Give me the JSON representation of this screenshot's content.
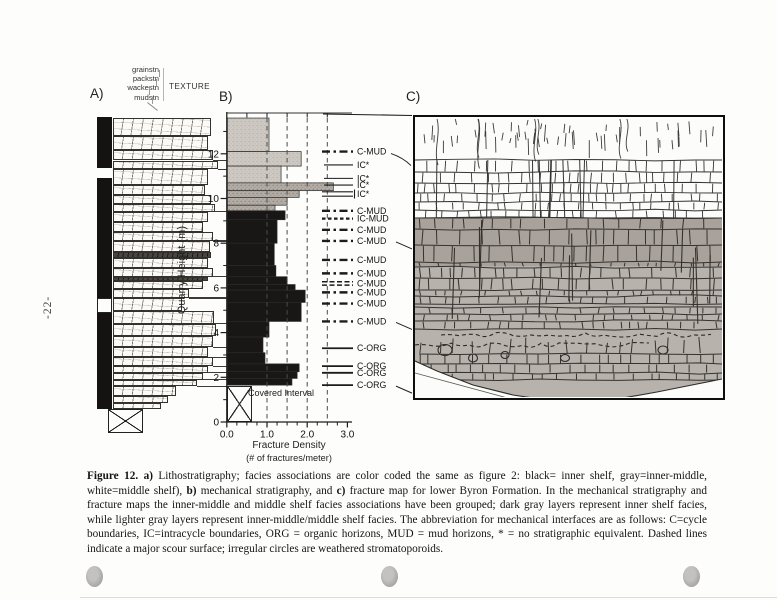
{
  "page": {
    "number": "-22-"
  },
  "panel_a": {
    "label": "A)",
    "texture_title": "TEXTURE",
    "texture_scale_labels": [
      "grainstn",
      "packstn",
      "wackestn",
      "mudstn"
    ],
    "facies_strip": [
      {
        "t": 13.65,
        "b": 11.35,
        "f": "black"
      },
      {
        "t": 11.35,
        "b": 10.9,
        "f": "white"
      },
      {
        "t": 10.9,
        "b": 5.55,
        "f": "black"
      },
      {
        "t": 5.55,
        "b": 4.88,
        "f": "outline"
      },
      {
        "t": 4.88,
        "b": 0.6,
        "f": "black"
      }
    ],
    "layers": [
      {
        "t": 13.6,
        "b": 12.8,
        "w": 0.93
      },
      {
        "t": 12.8,
        "b": 12.15,
        "w": 0.9
      },
      {
        "t": 12.15,
        "b": 11.7,
        "w": 0.95,
        "mk": true
      },
      {
        "t": 11.7,
        "b": 11.3,
        "w": 1.0,
        "mk": true
      },
      {
        "t": 11.3,
        "b": 10.6,
        "w": 0.9
      },
      {
        "t": 10.6,
        "b": 10.15,
        "w": 0.88
      },
      {
        "t": 10.15,
        "b": 9.75,
        "w": 0.93
      },
      {
        "t": 9.75,
        "b": 9.4,
        "w": 0.97,
        "mk": true
      },
      {
        "t": 9.4,
        "b": 8.95,
        "w": 0.9
      },
      {
        "t": 8.95,
        "b": 8.5,
        "w": 0.86
      },
      {
        "t": 8.5,
        "b": 8.1,
        "w": 0.95,
        "mk": true
      },
      {
        "t": 8.1,
        "b": 7.6,
        "w": 0.92
      },
      {
        "t": 7.6,
        "b": 7.35,
        "w": 0.93,
        "dk": true
      },
      {
        "t": 7.35,
        "b": 6.9,
        "w": 0.9
      },
      {
        "t": 6.9,
        "b": 6.5,
        "w": 0.95,
        "mk": true
      },
      {
        "t": 6.5,
        "b": 6.3,
        "w": 0.9,
        "dk": true
      },
      {
        "t": 6.3,
        "b": 5.95,
        "w": 0.86
      },
      {
        "t": 5.95,
        "b": 5.55,
        "w": 0.72,
        "mk": true
      },
      {
        "t": 5.55,
        "b": 4.95,
        "w": 0.66
      },
      {
        "t": 4.95,
        "b": 4.4,
        "w": 0.96,
        "mk": true
      },
      {
        "t": 4.4,
        "b": 3.85,
        "w": 0.98
      },
      {
        "t": 3.85,
        "b": 3.35,
        "w": 0.95,
        "mk": true
      },
      {
        "t": 3.35,
        "b": 2.9,
        "w": 0.9,
        "mk": true
      },
      {
        "t": 2.9,
        "b": 2.5,
        "w": 0.95,
        "mk": true
      },
      {
        "t": 2.5,
        "b": 2.2,
        "w": 0.9,
        "mk": true
      },
      {
        "t": 2.2,
        "b": 1.9,
        "w": 0.86,
        "mk": true
      },
      {
        "t": 1.9,
        "b": 1.6,
        "w": 0.8,
        "mk": true
      },
      {
        "t": 1.6,
        "b": 1.15,
        "w": 0.6
      },
      {
        "t": 1.15,
        "b": 0.85,
        "w": 0.52
      },
      {
        "t": 0.85,
        "b": 0.6,
        "w": 0.46
      }
    ]
  },
  "panel_b": {
    "label": "B)",
    "ylabel": "Quarry Height (m)",
    "xlabel_line1": "Fracture Density",
    "xlabel_line2": "(# of fractures/meter)",
    "covered_label": "Covered Interval"
  },
  "panel_c": {
    "label": "C)"
  },
  "chart_data": {
    "type": "bar",
    "orientation": "horizontal",
    "title": "",
    "xlabel": "Fracture Density (# of fractures/meter)",
    "ylabel": "Quarry Height (m)",
    "xlim": [
      0,
      3.0
    ],
    "ylim": [
      0,
      13.6
    ],
    "x_ticks": [
      0.0,
      1.0,
      2.0,
      3.0
    ],
    "x_minor_step": 0.25,
    "y_major_ticks": [
      0,
      2,
      4,
      6,
      8,
      10,
      12
    ],
    "y_minor_step": 1,
    "dashed_gridlines_x": [
      1.0,
      1.5,
      2.0,
      2.5
    ],
    "grid": true,
    "legend": false,
    "bars": [
      {
        "t": 13.6,
        "b": 12.1,
        "v": 1.05,
        "s": "light"
      },
      {
        "t": 12.1,
        "b": 11.45,
        "v": 1.85,
        "s": "light"
      },
      {
        "t": 11.45,
        "b": 10.7,
        "v": 1.35,
        "s": "light"
      },
      {
        "t": 10.7,
        "b": 10.35,
        "v": 2.65,
        "s": "medium"
      },
      {
        "t": 10.35,
        "b": 10.05,
        "v": 1.8,
        "s": "medium"
      },
      {
        "t": 10.05,
        "b": 9.7,
        "v": 1.5,
        "s": "medium"
      },
      {
        "t": 9.7,
        "b": 9.45,
        "v": 1.2,
        "s": "medium"
      },
      {
        "t": 9.45,
        "b": 9.05,
        "v": 1.45,
        "s": "black"
      },
      {
        "t": 9.05,
        "b": 8.0,
        "v": 1.25,
        "s": "black"
      },
      {
        "t": 8.0,
        "b": 7.0,
        "v": 1.18,
        "s": "black"
      },
      {
        "t": 7.0,
        "b": 6.5,
        "v": 1.22,
        "s": "black"
      },
      {
        "t": 6.5,
        "b": 6.15,
        "v": 1.5,
        "s": "black"
      },
      {
        "t": 6.15,
        "b": 5.9,
        "v": 1.7,
        "s": "black"
      },
      {
        "t": 5.9,
        "b": 5.35,
        "v": 1.95,
        "s": "black"
      },
      {
        "t": 5.35,
        "b": 4.5,
        "v": 1.85,
        "s": "black"
      },
      {
        "t": 4.5,
        "b": 3.8,
        "v": 1.05,
        "s": "black"
      },
      {
        "t": 3.8,
        "b": 3.1,
        "v": 0.9,
        "s": "black"
      },
      {
        "t": 3.1,
        "b": 2.6,
        "v": 0.95,
        "s": "black"
      },
      {
        "t": 2.6,
        "b": 2.25,
        "v": 1.8,
        "s": "black"
      },
      {
        "t": 2.25,
        "b": 1.95,
        "v": 1.75,
        "s": "black"
      },
      {
        "t": 1.95,
        "b": 1.65,
        "v": 1.62,
        "s": "black"
      }
    ],
    "covered_interval": {
      "top": 1.6,
      "bottom": 0,
      "width": 0.62,
      "label": "Covered Interval"
    },
    "interfaces": [
      {
        "m": 12.1,
        "label": "C-MUD",
        "style": "dashdot",
        "leader": "curve"
      },
      {
        "m": 11.5,
        "label": "IC*",
        "style": "solid"
      },
      {
        "m": 10.9,
        "label": "IC*",
        "style": "solid"
      },
      {
        "m": 10.6,
        "label": "IC*",
        "style": "solid"
      },
      {
        "m": 10.2,
        "label": "IC*",
        "style": "double"
      },
      {
        "m": 9.45,
        "label": "C-MUD",
        "style": "dashdot"
      },
      {
        "m": 9.1,
        "label": "IC-MUD",
        "style": "dash"
      },
      {
        "m": 8.6,
        "label": "C-MUD",
        "style": "dashdot"
      },
      {
        "m": 8.1,
        "label": "C-MUD",
        "style": "dashdot",
        "leader": "line"
      },
      {
        "m": 7.25,
        "label": "C-MUD",
        "style": "dashdot"
      },
      {
        "m": 6.65,
        "label": "C-MUD",
        "style": "dashdot"
      },
      {
        "m": 6.2,
        "label": "C-MUD",
        "style": "dense"
      },
      {
        "m": 5.8,
        "label": "C-MUD",
        "style": "dashdot"
      },
      {
        "m": 5.3,
        "label": "C-MUD",
        "style": "dashdot"
      },
      {
        "m": 4.5,
        "label": "C-MUD",
        "style": "dashdot",
        "leader": "line"
      },
      {
        "m": 3.3,
        "label": "C-ORG",
        "style": "solid2"
      },
      {
        "m": 2.5,
        "label": "C-ORG",
        "style": "solid2"
      },
      {
        "m": 2.2,
        "label": "C-ORG",
        "style": "solid2"
      },
      {
        "m": 1.65,
        "label": "C-ORG",
        "style": "solid2",
        "leader": "line"
      }
    ]
  },
  "caption": {
    "segments": [
      {
        "text": "Figure 12.",
        "bold": true
      },
      {
        "text": "  ",
        "bold": false
      },
      {
        "text": "a)",
        "bold": true
      },
      {
        "text": " Lithostratigraphy; facies associations are color coded the same as figure 2: black= inner shelf, gray=inner-middle, white=middle shelf), ",
        "bold": false
      },
      {
        "text": "b)",
        "bold": true
      },
      {
        "text": " mechanical stratigraphy, and ",
        "bold": false
      },
      {
        "text": "c)",
        "bold": true
      },
      {
        "text": " fracture map for lower Byron Formation.  In the mechanical stratigraphy and fracture maps the inner-middle and middle shelf facies associations have been grouped; dark gray layers represent inner shelf facies, while  lighter gray layers represent inner-middle/middle shelf facies.  The abbreviation for mechanical interfaces are as follows: C=cycle boundaries, IC=intracycle boundaries, ORG = organic horizons, MUD = mud horizons, * = no stratigraphic equivalent.  Dashed lines indicate a major scour surface; irregular circles are weathered stromatoporoids.",
        "bold": false
      }
    ]
  }
}
